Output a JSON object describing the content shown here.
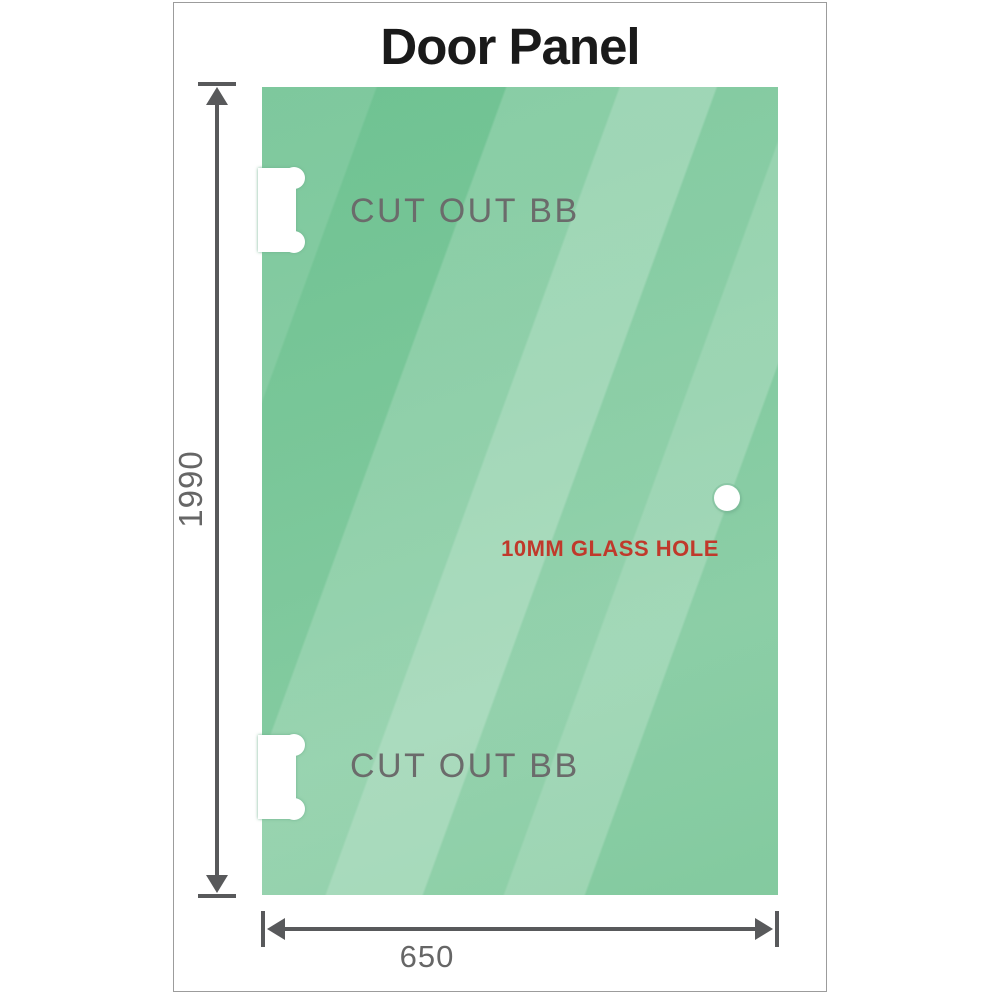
{
  "title": "Door Panel",
  "cutouts": [
    {
      "label": "CUT OUT BB",
      "position": "top-left"
    },
    {
      "label": "CUT OUT BB",
      "position": "bottom-left"
    }
  ],
  "glass_hole": {
    "label": "10MM GLASS HOLE"
  },
  "dimensions": {
    "height_label": "1990",
    "width_label": "650"
  },
  "colors": {
    "glass_green": "#6cc190",
    "glass_light": "#a9dcbe",
    "dimension_gray": "#58595b",
    "label_gray": "#6b6b6b",
    "hole_label_red": "#c0392b",
    "frame_border": "#9c9c9c"
  }
}
